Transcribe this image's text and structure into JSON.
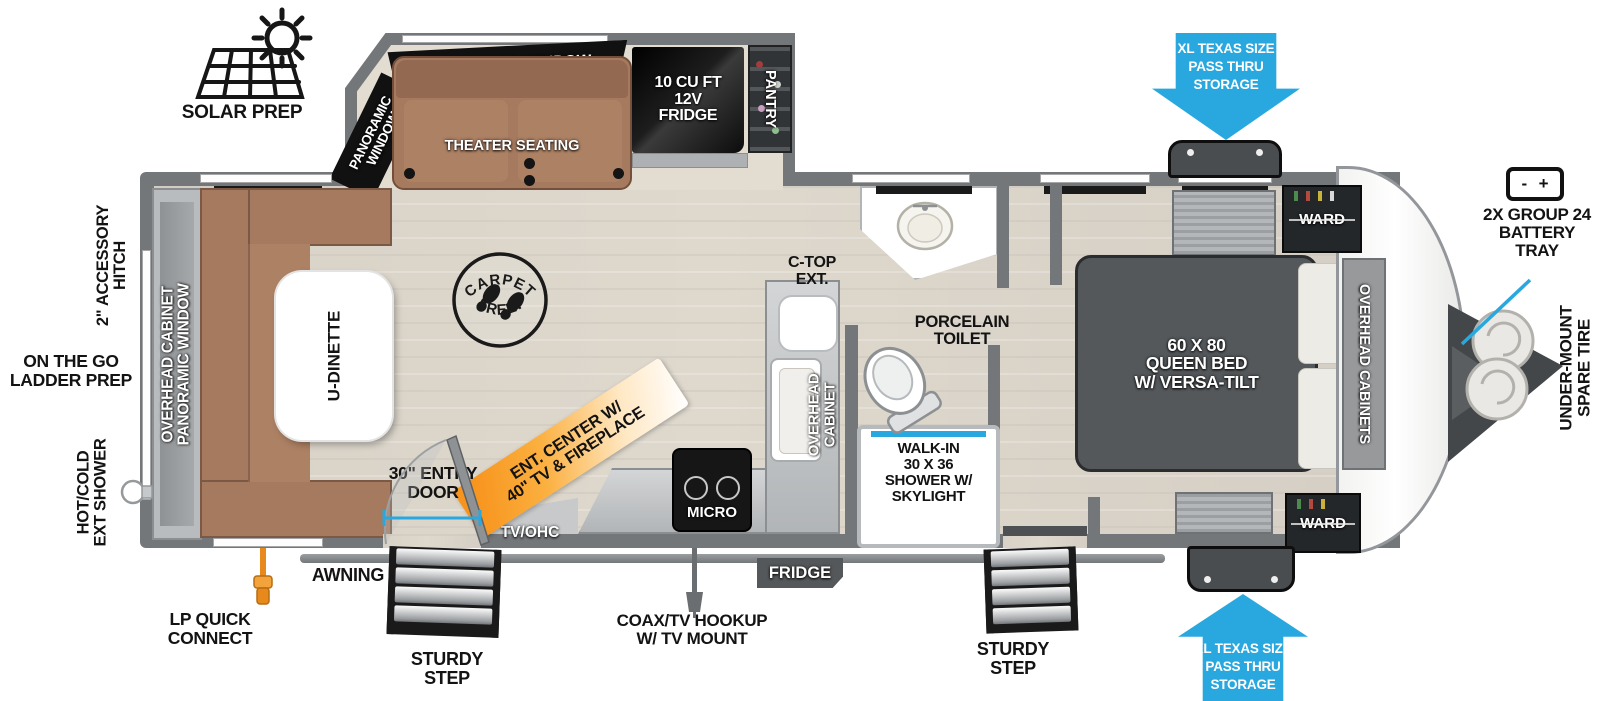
{
  "colors": {
    "arrow_blue": "#29a8e0",
    "callout_blue": "#29a8e0",
    "accent_orange": "#f7941d",
    "wall_gray": "#74777a",
    "couch_brown": "#a67a5e",
    "bed_gray": "#54585b"
  },
  "exterior": {
    "solar_prep": "SOLAR PREP",
    "accessory_hitch": [
      "2\" ACCESSORY",
      "HITCH"
    ],
    "ladder_prep": [
      "ON THE GO",
      "LADDER PREP"
    ],
    "ext_shower": [
      "HOT/COLD",
      "EXT SHOWER"
    ],
    "lp_quick_connect": [
      "LP QUICK",
      "CONNECT"
    ],
    "awning": "AWNING",
    "sturdy_step": [
      "STURDY",
      "STEP"
    ],
    "coax": [
      "COAX/TV HOOKUP",
      "W/ TV MOUNT"
    ],
    "fridge_exterior": "FRIDGE",
    "entry_door": [
      "30\" ENTRY",
      "DOOR"
    ],
    "pass_thru": [
      "XL TEXAS SIZE",
      "PASS THRU",
      "STORAGE"
    ],
    "battery": [
      "2X GROUP 24",
      "BATTERY",
      "TRAY"
    ],
    "battery_minus": "-",
    "battery_plus": "+",
    "spare_tire": [
      "UNDER-MOUNT",
      "SPARE TIRE"
    ]
  },
  "interior": {
    "panoramic_window": "PANORAMIC WINDOW",
    "panoramic_window_side": [
      "PANORAMIC",
      "WINDOW"
    ],
    "theater_seating": "THEATER SEATING",
    "fridge_12v": [
      "10 CU FT",
      "12V",
      "FRIDGE"
    ],
    "pantry": "PANTRY",
    "rear_cabinet": [
      "OVERHEAD CABINET",
      "PANORAMIC WINDOW"
    ],
    "u_dinette": "U-DINETTE",
    "carpet_free": [
      "CARPET",
      "FREE!"
    ],
    "tv_ohc": "TV/OHC",
    "ent_center": [
      "ENT. CENTER W/",
      "40\" TV & FIREPLACE"
    ],
    "micro": "MICRO",
    "kitchen_cabinet": [
      "OVERHEAD",
      "CABINET"
    ],
    "c_top_ext": [
      "C-TOP",
      "EXT."
    ],
    "porcelain_toilet": [
      "PORCELAIN",
      "TOILET"
    ],
    "shower": [
      "WALK-IN",
      "30 X 36",
      "SHOWER W/",
      "SKYLIGHT"
    ],
    "queen_bed": [
      "60 X  80",
      "QUEEN BED",
      "W/ VERSA-TILT"
    ],
    "overhead_cabinets": "OVERHEAD CABINETS",
    "ward": "WARD"
  }
}
